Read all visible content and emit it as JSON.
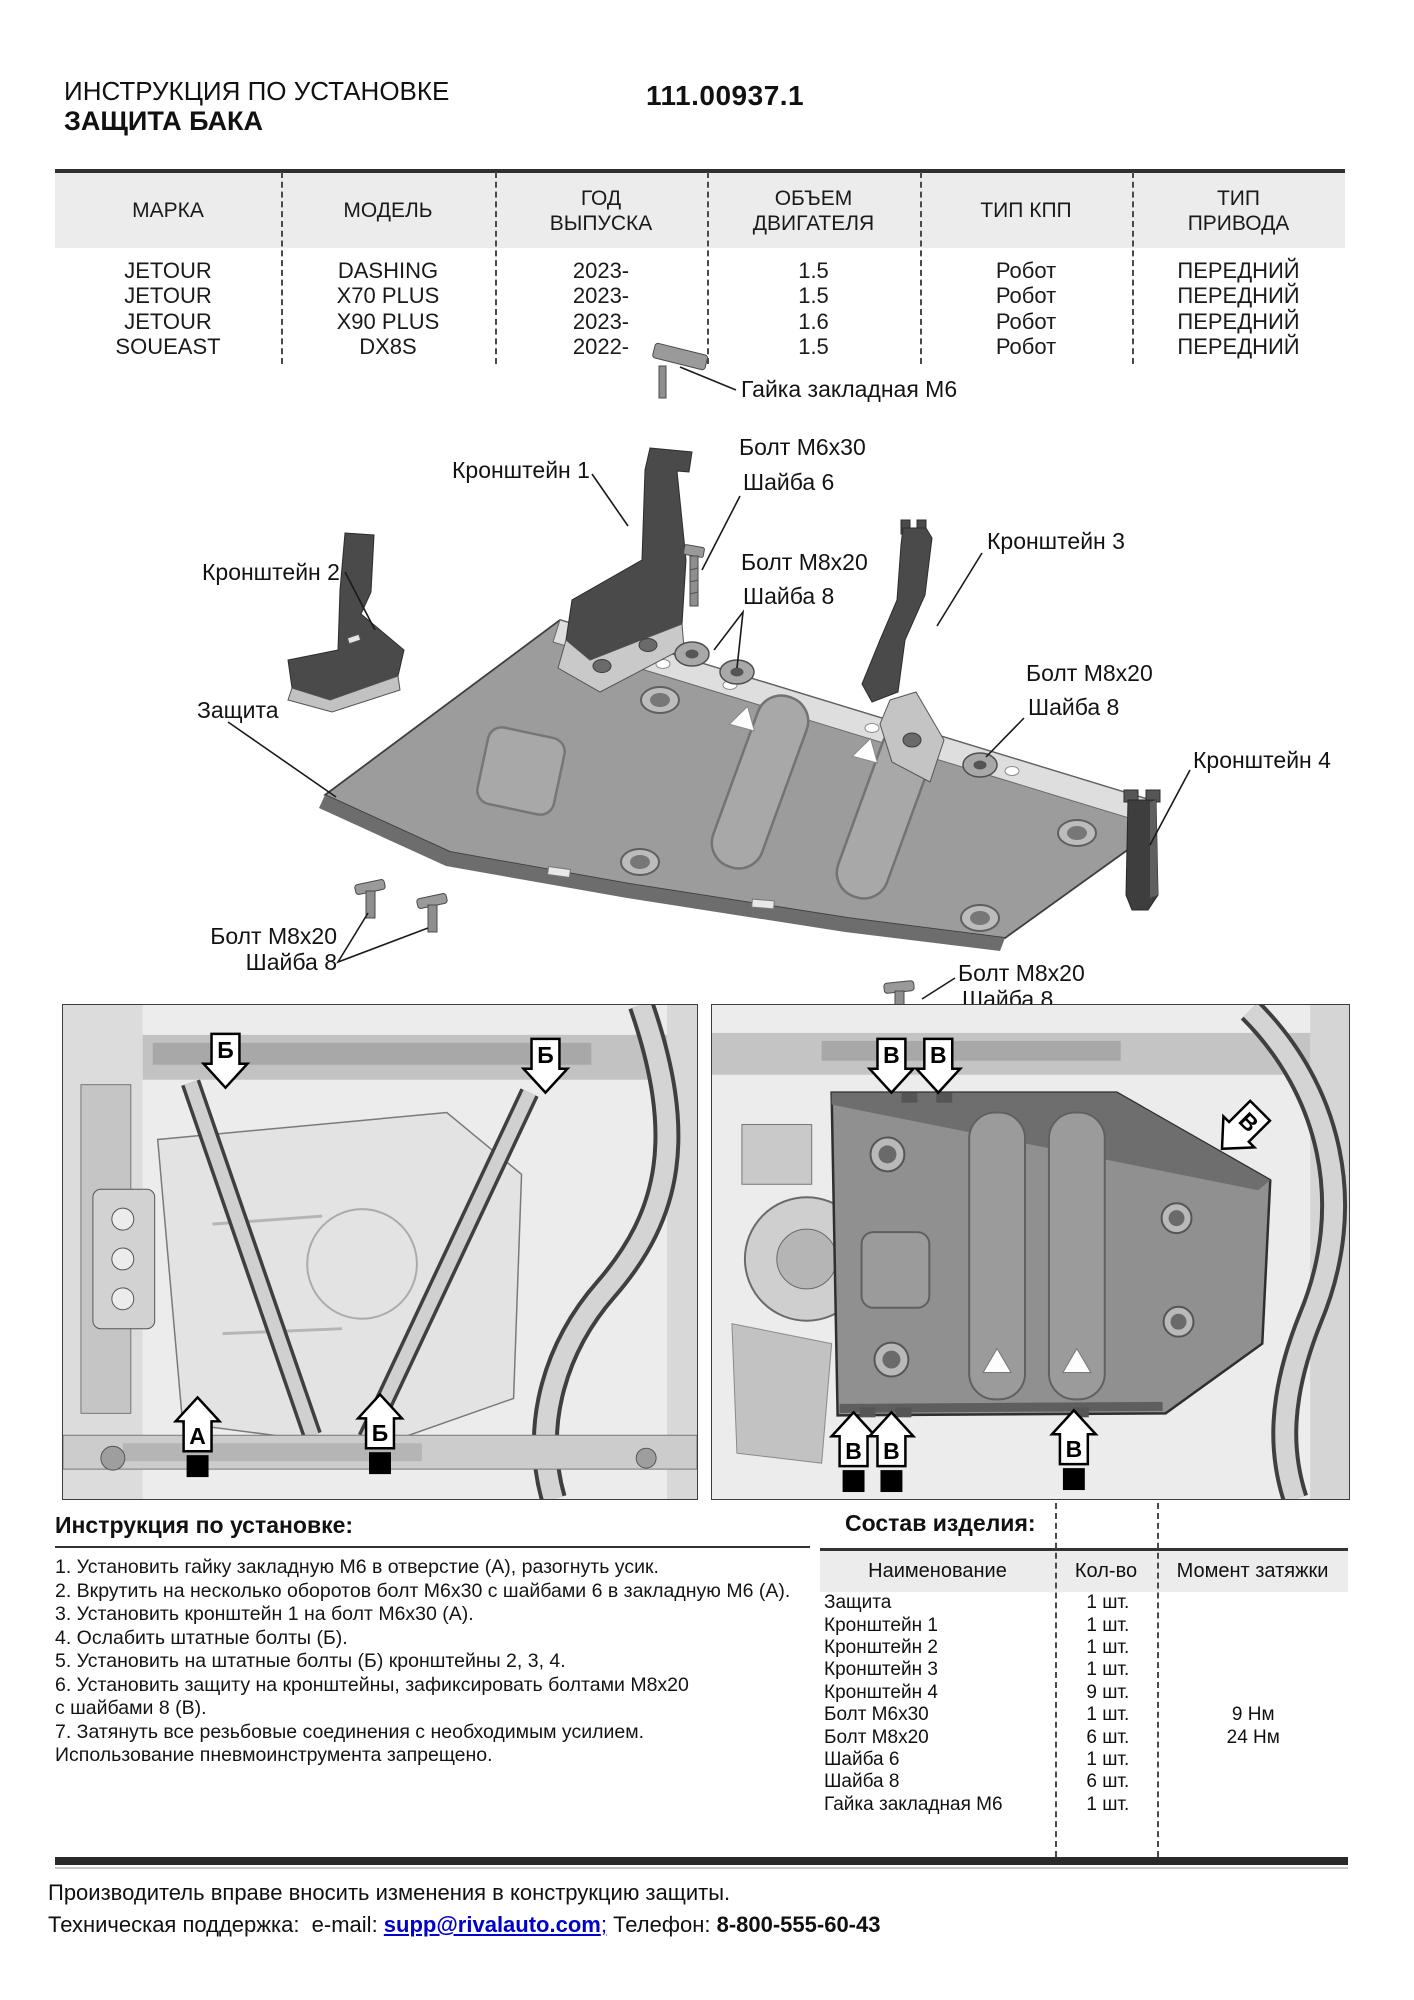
{
  "header": {
    "doc_type": "ИНСТРУКЦИЯ ПО УСТАНОВКЕ",
    "product": "ЗАЩИТА БАКА",
    "part_number": "111.00937.1"
  },
  "vehicle_table": {
    "columns": [
      "МАРКА",
      "МОДЕЛЬ",
      "ГОД\nВЫПУСКА",
      "ОБЪЕМ\nДВИГАТЕЛЯ",
      "ТИП КПП",
      "ТИП\nПРИВОДА"
    ],
    "rows": [
      {
        "brand": "JETOUR",
        "model": "DASHING",
        "year": "2023-",
        "engine": "1.5",
        "gearbox": "Робот",
        "drive": "ПЕРЕДНИЙ"
      },
      {
        "brand": "JETOUR",
        "model": "X70 PLUS",
        "year": "2023-",
        "engine": "1.5",
        "gearbox": "Робот",
        "drive": "ПЕРЕДНИЙ"
      },
      {
        "brand": "JETOUR",
        "model": "X90 PLUS",
        "year": "2023-",
        "engine": "1.6",
        "gearbox": "Робот",
        "drive": "ПЕРЕДНИЙ"
      },
      {
        "brand": "SOUEAST",
        "model": "DX8S",
        "year": "2022-",
        "engine": "1.5",
        "gearbox": "Робот",
        "drive": "ПЕРЕДНИЙ"
      }
    ]
  },
  "diagram": {
    "labels": {
      "clinch_nut": "Гайка закладная М6",
      "bolt_m6x30": "Болт М6х30",
      "washer_6": "Шайба 6",
      "bolt_m8x20": "Болт М8х20",
      "washer_8": "Шайба 8",
      "bracket_1": "Кронштейн 1",
      "bracket_2": "Кронштейн 2",
      "bracket_3": "Кронштейн 3",
      "bracket_4": "Кронштейн 4",
      "shield": "Защита"
    }
  },
  "photos": {
    "left": {
      "markers": [
        "Б",
        "Б",
        "А",
        "Б"
      ]
    },
    "right": {
      "markers": [
        "В",
        "В",
        "В",
        "В",
        "В",
        "В"
      ]
    }
  },
  "install": {
    "heading": "Инструкция по установке:",
    "lines": [
      "1. Установить гайку закладную М6 в отверстие (А), разогнуть усик.",
      "2. Вкрутить на несколько оборотов болт М6х30 с шайбами 6 в закладную М6 (А).",
      "3. Установить кронштейн 1 на болт М6х30 (А).",
      "4. Ослабить штатные болты (Б).",
      "5. Установить на штатные болты (Б) кронштейны 2, 3, 4.",
      "6. Установить защиту на кронштейны, зафиксировать болтами М8х20",
      "с шайбами 8 (В).",
      "7. Затянуть все резьбовые соединения с необходимым усилием.",
      "Использование пневмоинструмента запрещено."
    ]
  },
  "parts": {
    "heading": "Состав изделия:",
    "columns": [
      "Наименование",
      "Кол-во",
      "Момент затяжки"
    ],
    "rows": [
      {
        "name": "Защита",
        "qty": "1 шт.",
        "torque": ""
      },
      {
        "name": "Кронштейн 1",
        "qty": "1 шт.",
        "torque": ""
      },
      {
        "name": "Кронштейн 2",
        "qty": "1 шт.",
        "torque": ""
      },
      {
        "name": "Кронштейн 3",
        "qty": "1 шт.",
        "torque": ""
      },
      {
        "name": "Кронштейн 4",
        "qty": "9 шт.",
        "torque": ""
      },
      {
        "name": "Болт М6х30",
        "qty": "1 шт.",
        "torque": "9 Нм"
      },
      {
        "name": "Болт М8х20",
        "qty": "6 шт.",
        "torque": "24 Нм"
      },
      {
        "name": "Шайба 6",
        "qty": "1 шт.",
        "torque": ""
      },
      {
        "name": "Шайба 8",
        "qty": "6 шт.",
        "torque": ""
      },
      {
        "name": "Гайка закладная М6",
        "qty": "1 шт.",
        "torque": ""
      }
    ]
  },
  "footer": {
    "disclaimer": "Производитель вправе вносить изменения в конструкцию защиты.",
    "support_prefix": "Техническая поддержка:  e-mail: ",
    "email": "supp@rivalauto.com",
    "email_suffix": ";",
    "phone_label": " Телефон: ",
    "phone": "8-800-555-60-43"
  }
}
